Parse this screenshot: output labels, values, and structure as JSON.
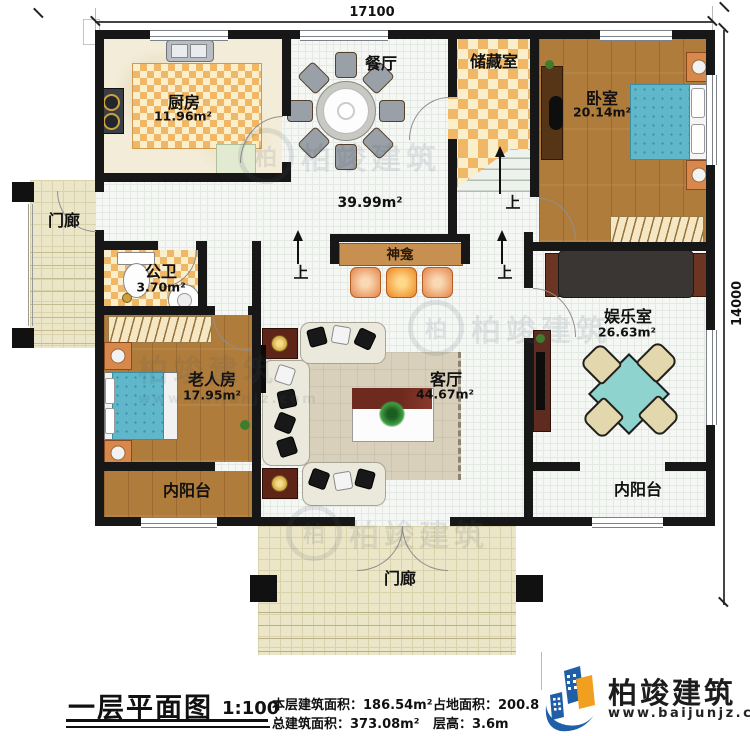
{
  "dimensions": {
    "top": "17100",
    "right": "14000"
  },
  "rooms": {
    "kitchen": {
      "name": "厨房",
      "area": "11.96m²"
    },
    "dining": {
      "name": "餐厅"
    },
    "hall": {
      "area": "39.99m²"
    },
    "storage": {
      "name": "储藏室"
    },
    "bedroom": {
      "name": "卧室",
      "area": "20.14m²"
    },
    "porch_left": {
      "name": "门廊"
    },
    "bathroom": {
      "name": "公卫",
      "area": "3.70m²"
    },
    "elder_room": {
      "name": "老人房",
      "area": "17.95m²"
    },
    "living": {
      "name": "客厅",
      "area": "44.67m²"
    },
    "shrine": {
      "name": "神龛"
    },
    "entertainment": {
      "name": "娱乐室",
      "area": "26.63m²"
    },
    "balcony_left": {
      "name": "内阳台"
    },
    "balcony_right": {
      "name": "内阳台"
    },
    "porch_bottom": {
      "name": "门廊"
    }
  },
  "annotations": {
    "up": "上"
  },
  "title_block": {
    "title": "一层平面图",
    "scale": "1:100",
    "stats": [
      {
        "label": "本层建筑面积：",
        "value": "186.54m²"
      },
      {
        "label": "占地面积：",
        "value": "200.8"
      },
      {
        "label": "总建筑面积：",
        "value": "373.08m²"
      },
      {
        "label": "层高：",
        "value": "3.6m"
      }
    ]
  },
  "logo": {
    "name": "柏竣建筑",
    "url": "www.baijunjz.com",
    "initial": "柏"
  },
  "watermark": {
    "text": "柏竣建筑"
  },
  "colors": {
    "wall": "#171717",
    "checker": "#efb766",
    "wood": "#b07c3c",
    "bed_teal": "#5fb7c9",
    "brand_blue": "#1f5fa8",
    "brand_orange": "#f0a01e"
  }
}
